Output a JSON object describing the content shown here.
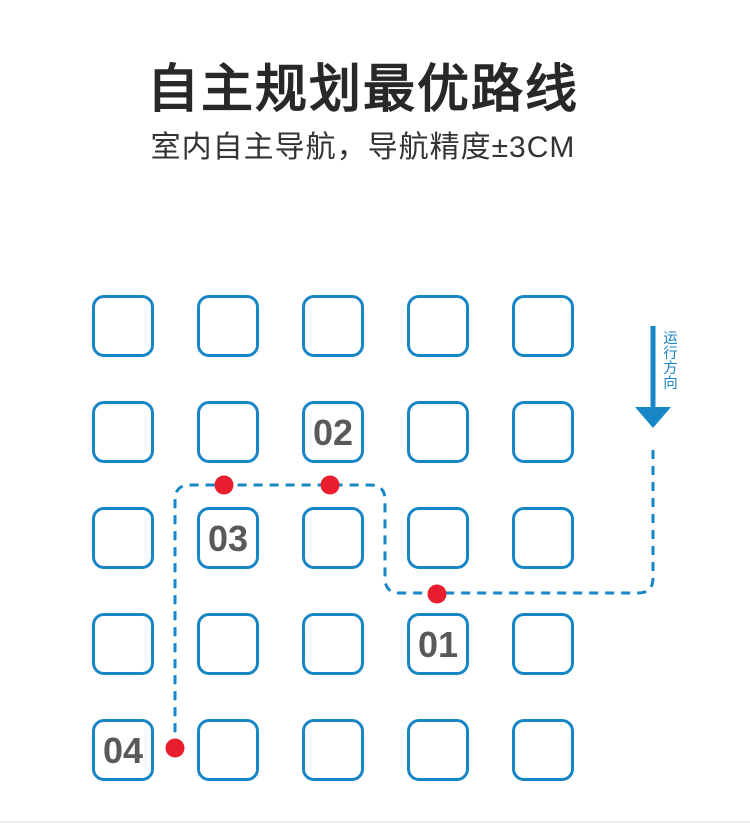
{
  "header": {
    "title": "自主规划最优路线",
    "subtitle": "室内自主导航，导航精度±3CM"
  },
  "diagram": {
    "direction_label": "运行方向",
    "grid": {
      "rows": 5,
      "cols": 5
    },
    "stops": [
      {
        "label": "01",
        "row": 4,
        "col": 4
      },
      {
        "label": "02",
        "row": 2,
        "col": 3
      },
      {
        "label": "03",
        "row": 3,
        "col": 2
      },
      {
        "label": "04",
        "row": 5,
        "col": 1
      }
    ],
    "route": {
      "dots": [
        {
          "near_stop": "01",
          "x": 437,
          "y": 594
        },
        {
          "near_stop": "02",
          "x": 330,
          "y": 485
        },
        {
          "near_stop": "03",
          "x": 224,
          "y": 485
        },
        {
          "near_stop": "04",
          "x": 175,
          "y": 748
        }
      ]
    }
  },
  "colors": {
    "blue": "#1786c6",
    "red": "#e81e2e",
    "gray": "#59595b"
  }
}
